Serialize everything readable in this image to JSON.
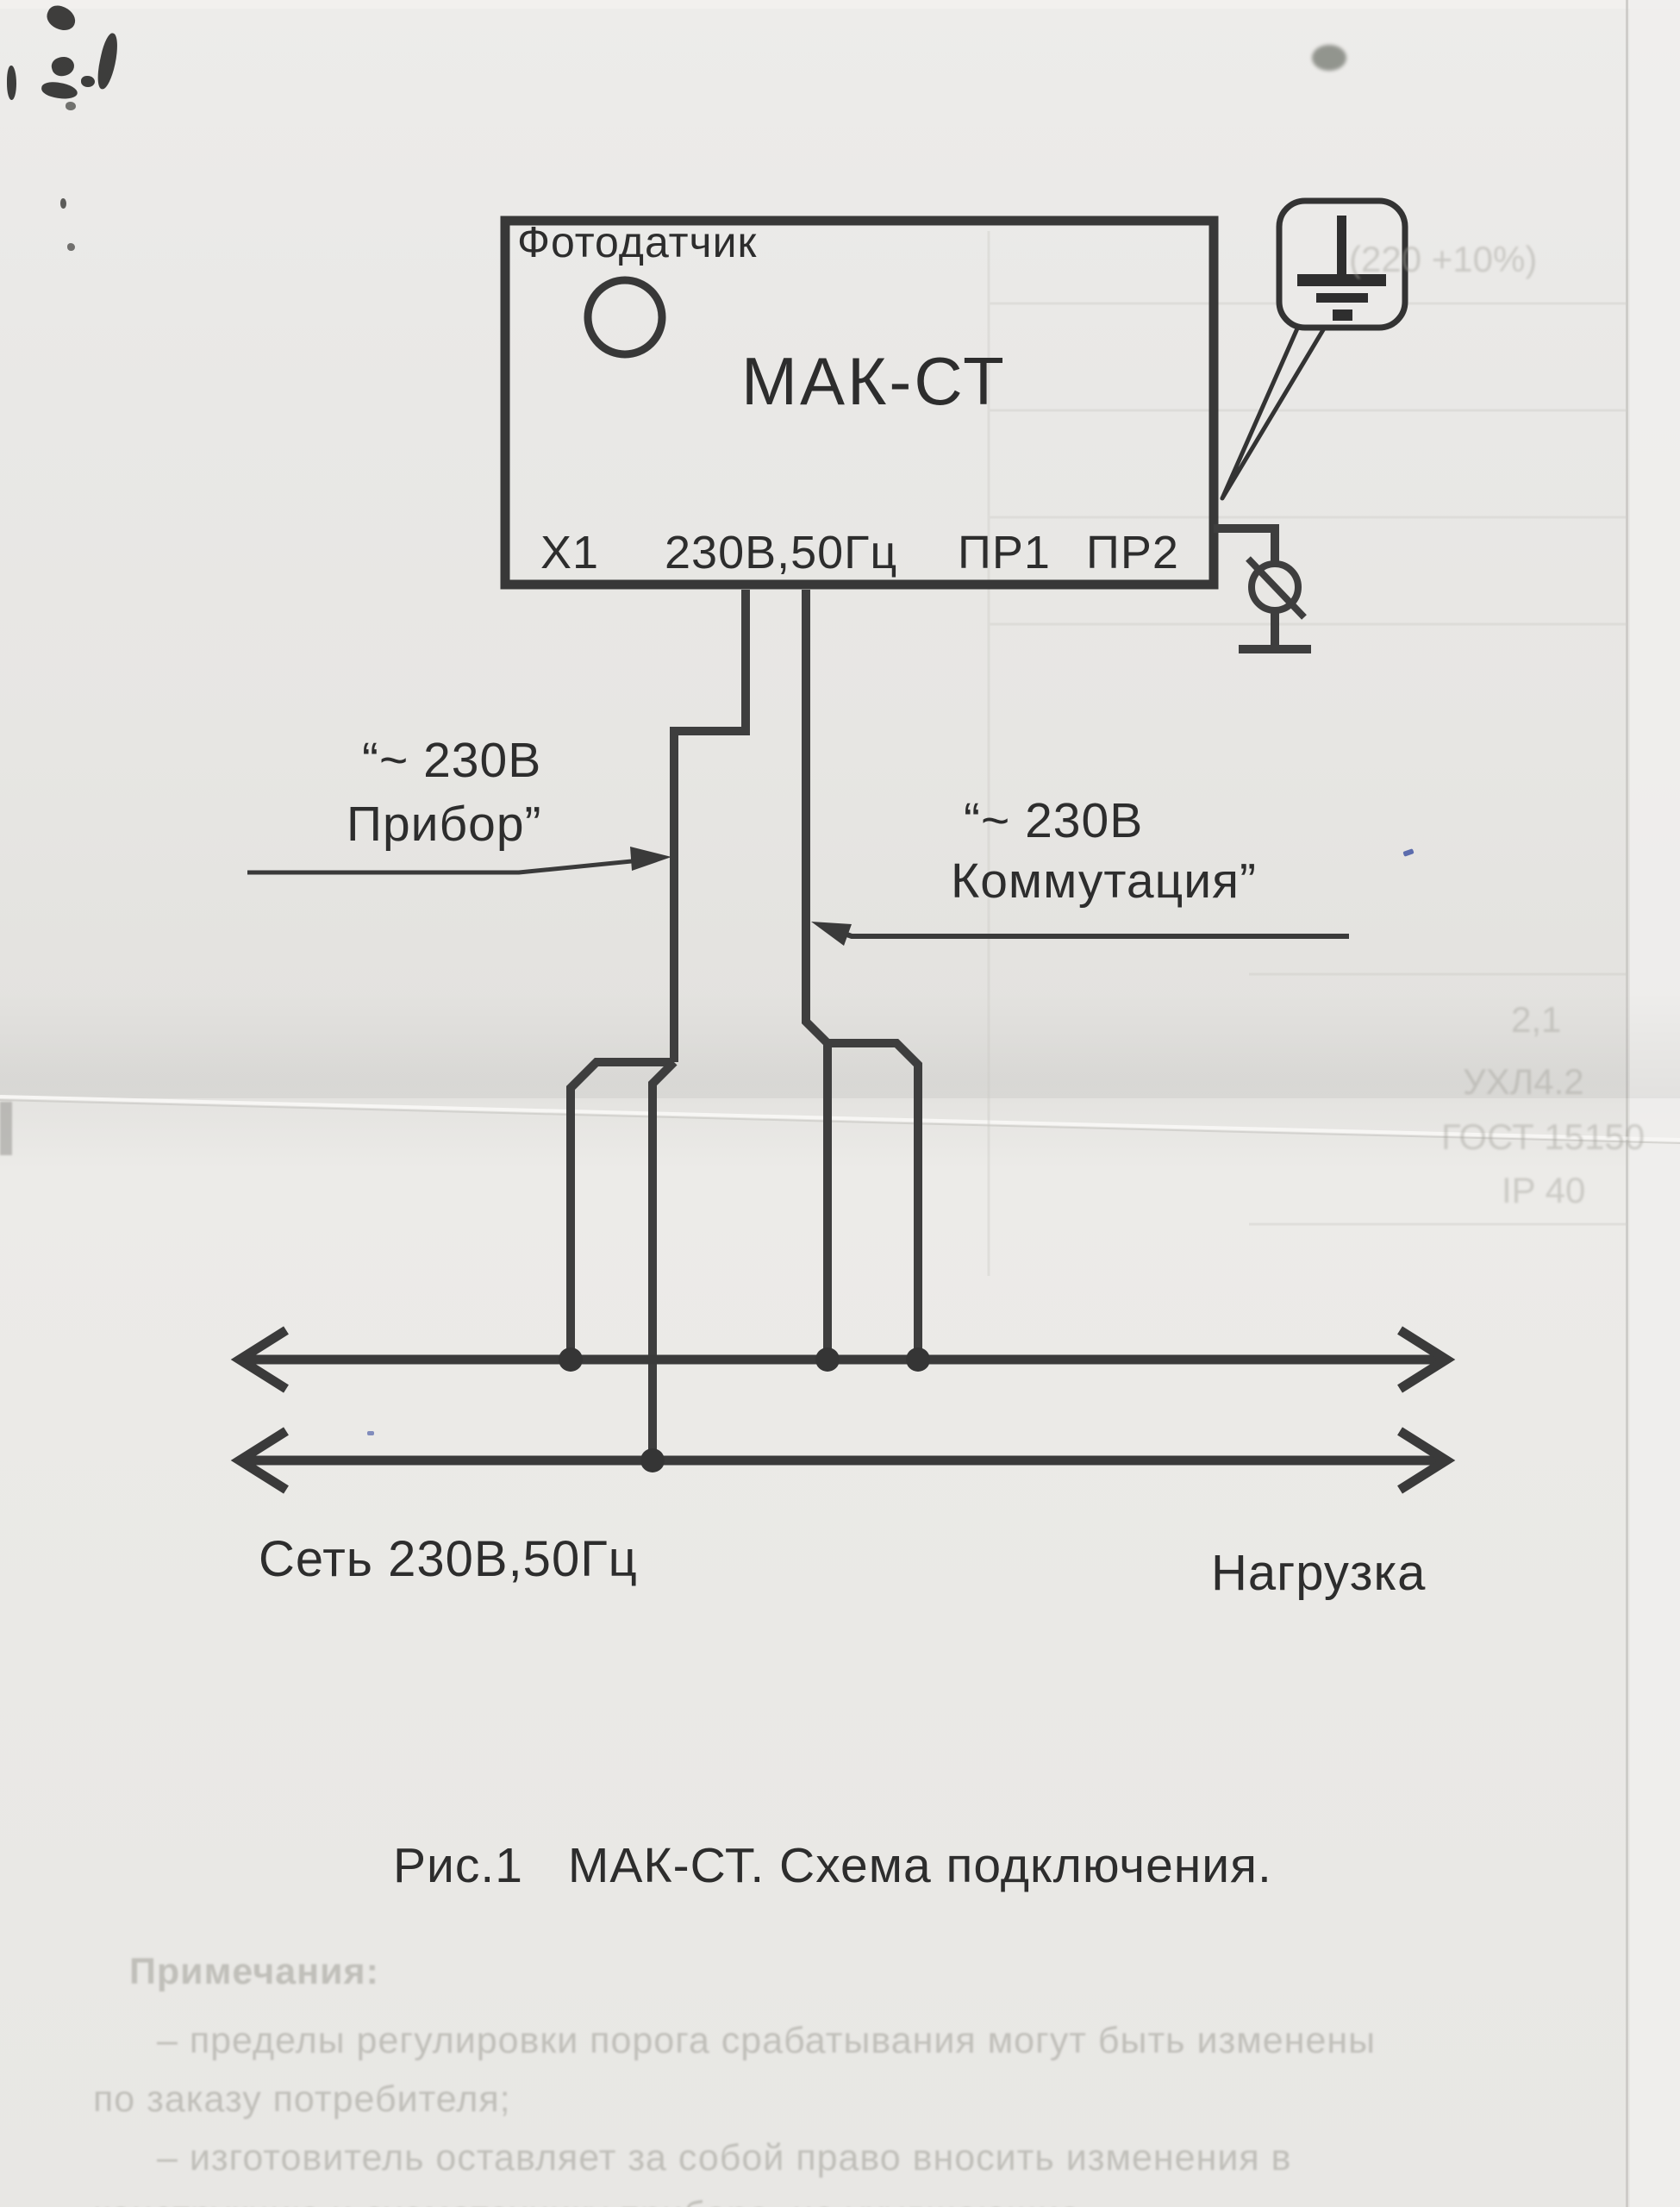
{
  "device": {
    "photosensor_label": "Фотодатчик",
    "model": "МАК-СТ",
    "terminals": [
      "Х1",
      "230В,50Гц",
      "ПР1",
      "ПР2"
    ]
  },
  "connections": {
    "instrument_line1": "“~ 230В",
    "instrument_line2": "Прибор”",
    "switching_line1": "“~ 230В",
    "switching_line2": "Коммутация”",
    "mains_label": "Сеть 230В,50Гц",
    "load_label": "Нагрузка"
  },
  "caption": {
    "figure": "Рис.1",
    "text": "МАК-СТ. Схема подключения."
  },
  "icons": {
    "earth": "earth-ground-icon",
    "bolt": "chassis-bolt-icon",
    "electrode": "ground-electrode-icon",
    "photosensor": "photosensor-circle"
  },
  "colors": {
    "paper": "#e9e8e6",
    "ink": "#383838",
    "wire": "#3e3e3e",
    "bleed_text": "#98978f"
  },
  "bleedthrough": {
    "notes_title": "Примечания:",
    "notes_lines": [
      "– пределы регулировки порога срабатывания могут быть изменены",
      "по заказу потребителя;",
      "– изготовитель оставляет за собой право вносить изменения в",
      "конструкцию и схемотехнику прибора, не ухудшающие"
    ],
    "specs": [
      "(220 +10%)",
      "2,1",
      "УХЛ4.2",
      "ГОСТ 15150",
      "IP 40"
    ]
  }
}
